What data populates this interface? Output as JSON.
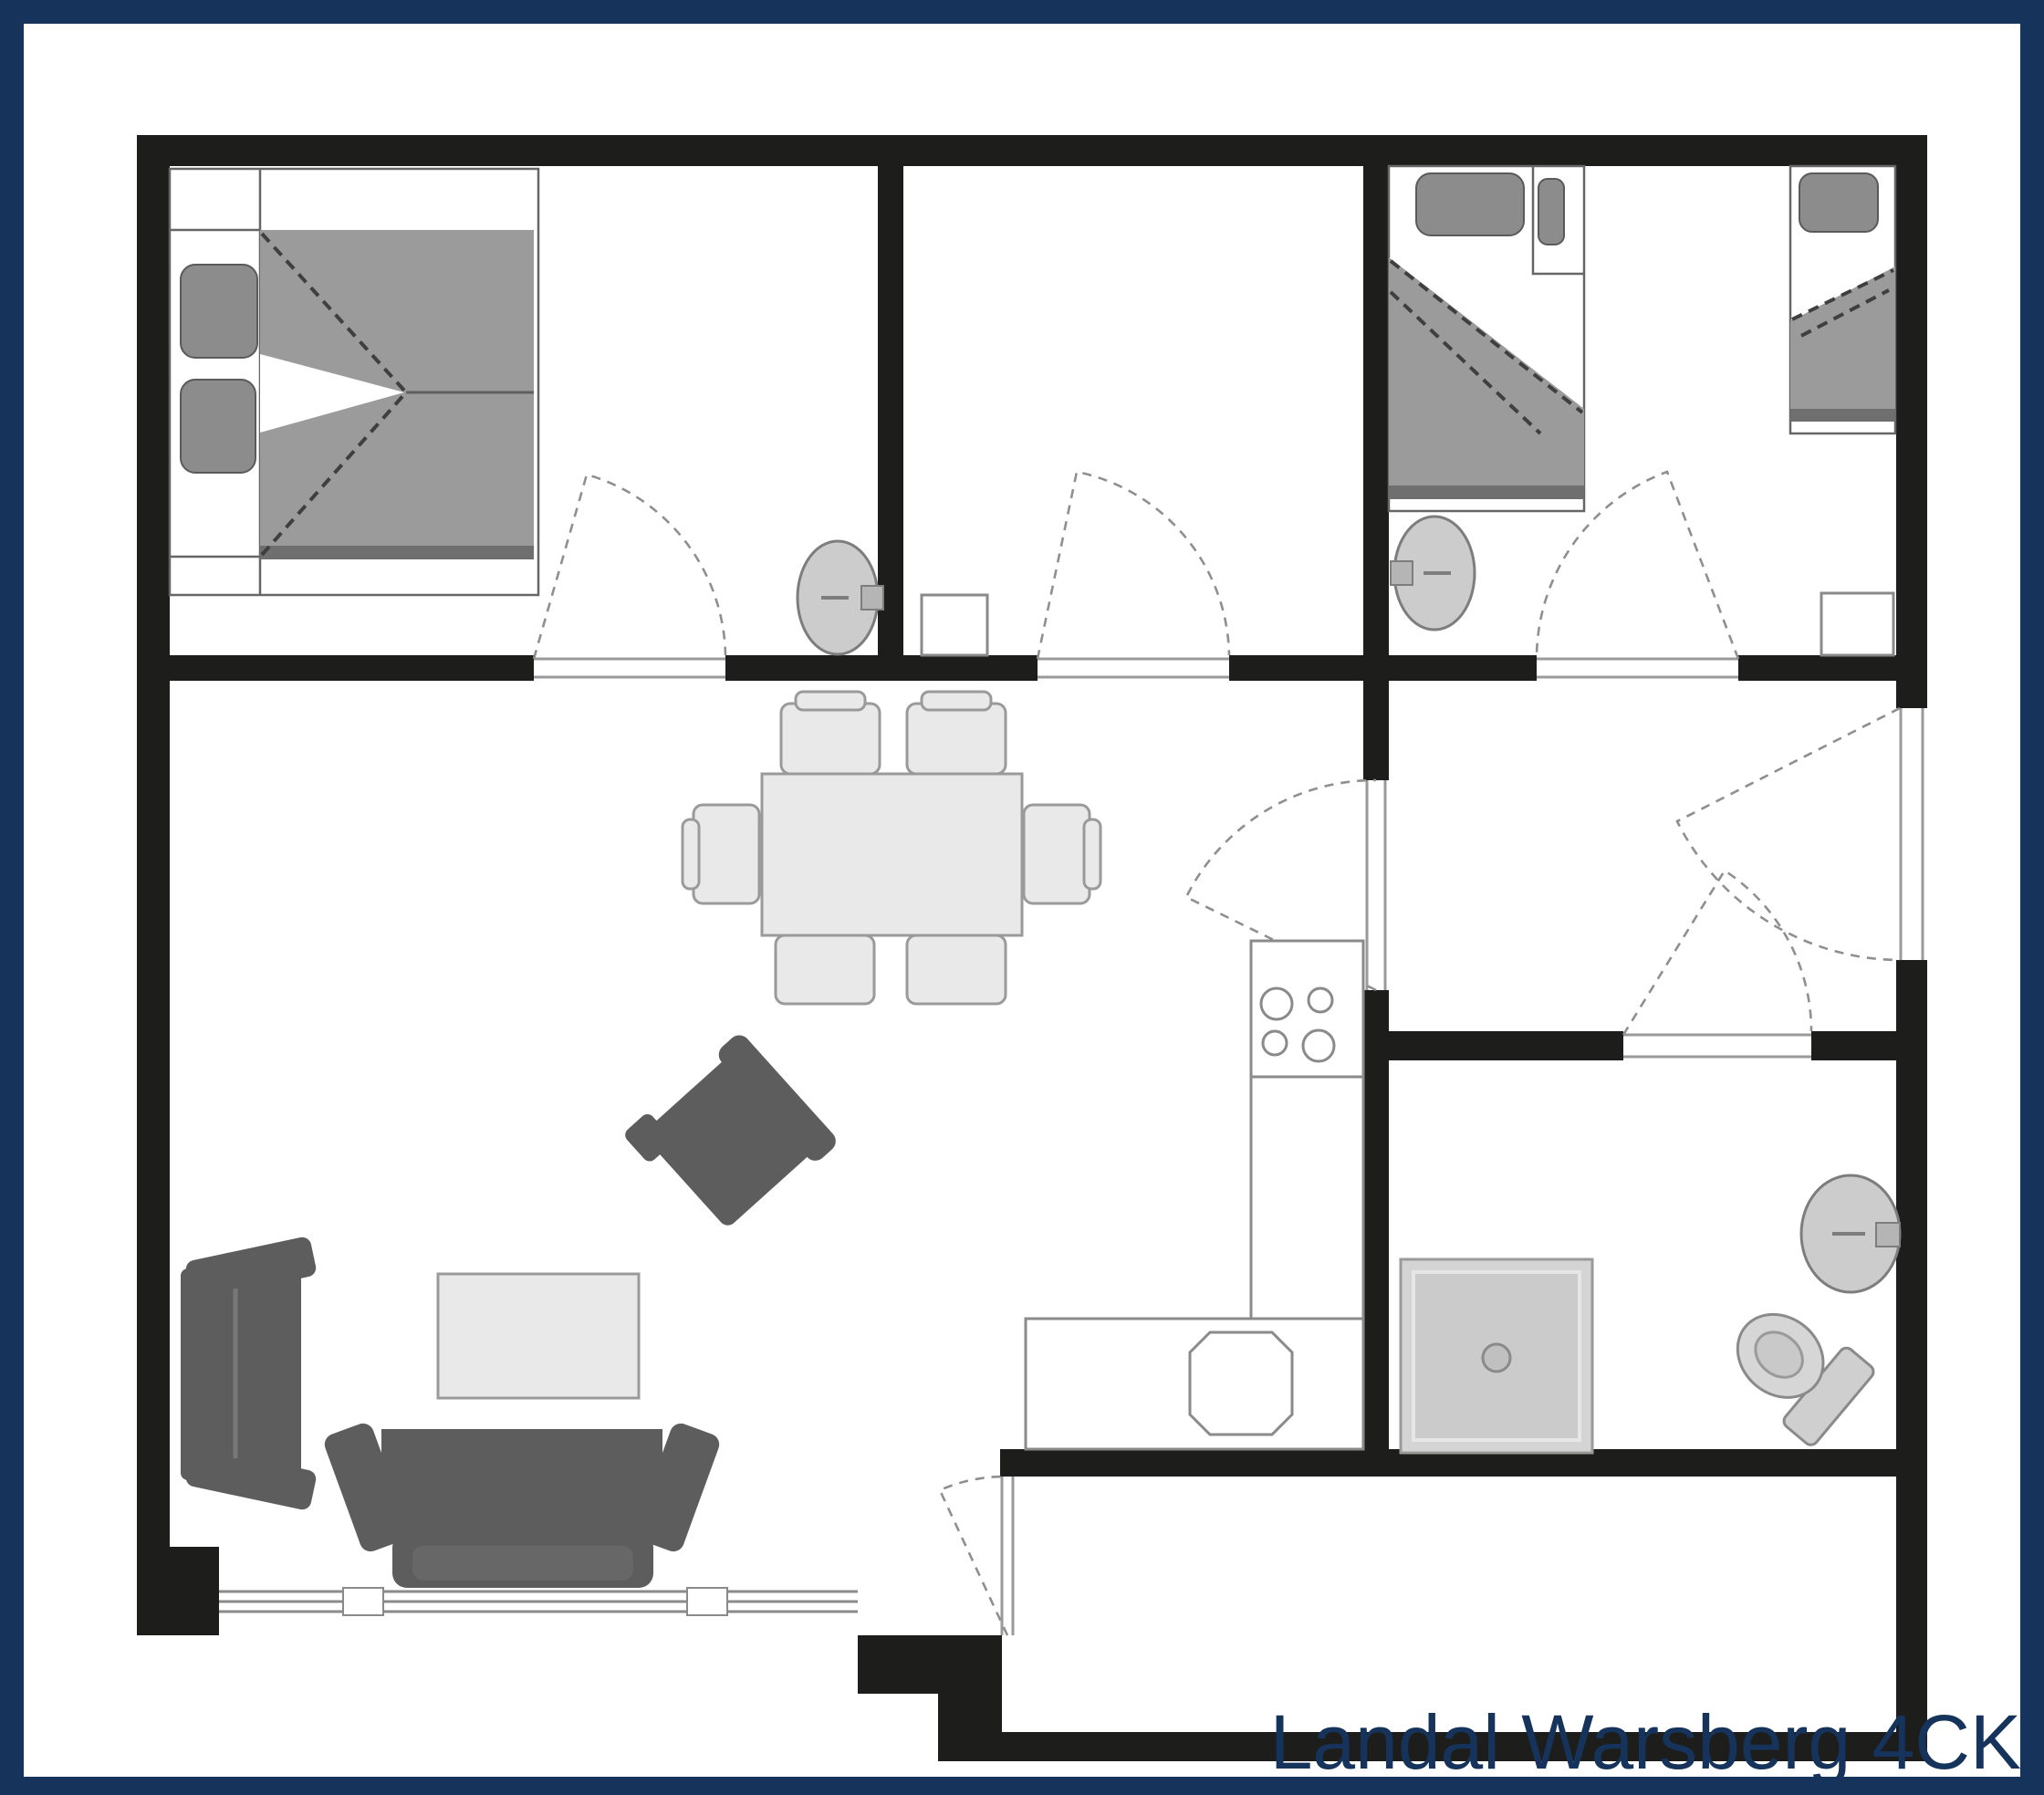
{
  "title": {
    "label": "Landal Warsberg 4CK",
    "color": "#16335b"
  },
  "palette": {
    "frame_navy": "#16335b",
    "wall_black": "#1d1d1b",
    "canvas_white": "#ffffff",
    "furniture_dark_gray": "#5d5d5d",
    "bedding_gray": "#9b9b9b",
    "pillow_gray": "#8c8c8c",
    "furniture_light_gray": "#e9e9e9",
    "fixture_gray": "#cccccc",
    "outline_gray": "#8a8a8a"
  },
  "floorplan": {
    "unit_name": "Landal Warsberg 4CK",
    "rooms": [
      {
        "name": "bedroom-double",
        "features": [
          "double-bed",
          "two-pillows",
          "wash-basin",
          "hinged-door"
        ]
      },
      {
        "name": "bedroom-middle",
        "features": [
          "side-table",
          "hinged-door"
        ]
      },
      {
        "name": "bedroom-twin",
        "features": [
          "single-bed-left",
          "single-bed-right",
          "wash-basin",
          "side-table",
          "hinged-door"
        ]
      },
      {
        "name": "living-room",
        "features": [
          "dining-table",
          "six-dining-chairs",
          "wall-sofa",
          "three-seat-sofa",
          "armchair",
          "coffee-table",
          "window-front"
        ]
      },
      {
        "name": "open-kitchen",
        "features": [
          "l-shaped-counter",
          "hob-4-burners",
          "kitchen-sink",
          "door-to-hallway"
        ]
      },
      {
        "name": "hallway",
        "features": [
          "entrance-door-right-wall"
        ]
      },
      {
        "name": "bathroom",
        "features": [
          "shower",
          "toilet",
          "wash-basin",
          "hinged-door"
        ]
      },
      {
        "name": "porch-storage",
        "features": [
          "door-to-living-room"
        ]
      }
    ]
  }
}
